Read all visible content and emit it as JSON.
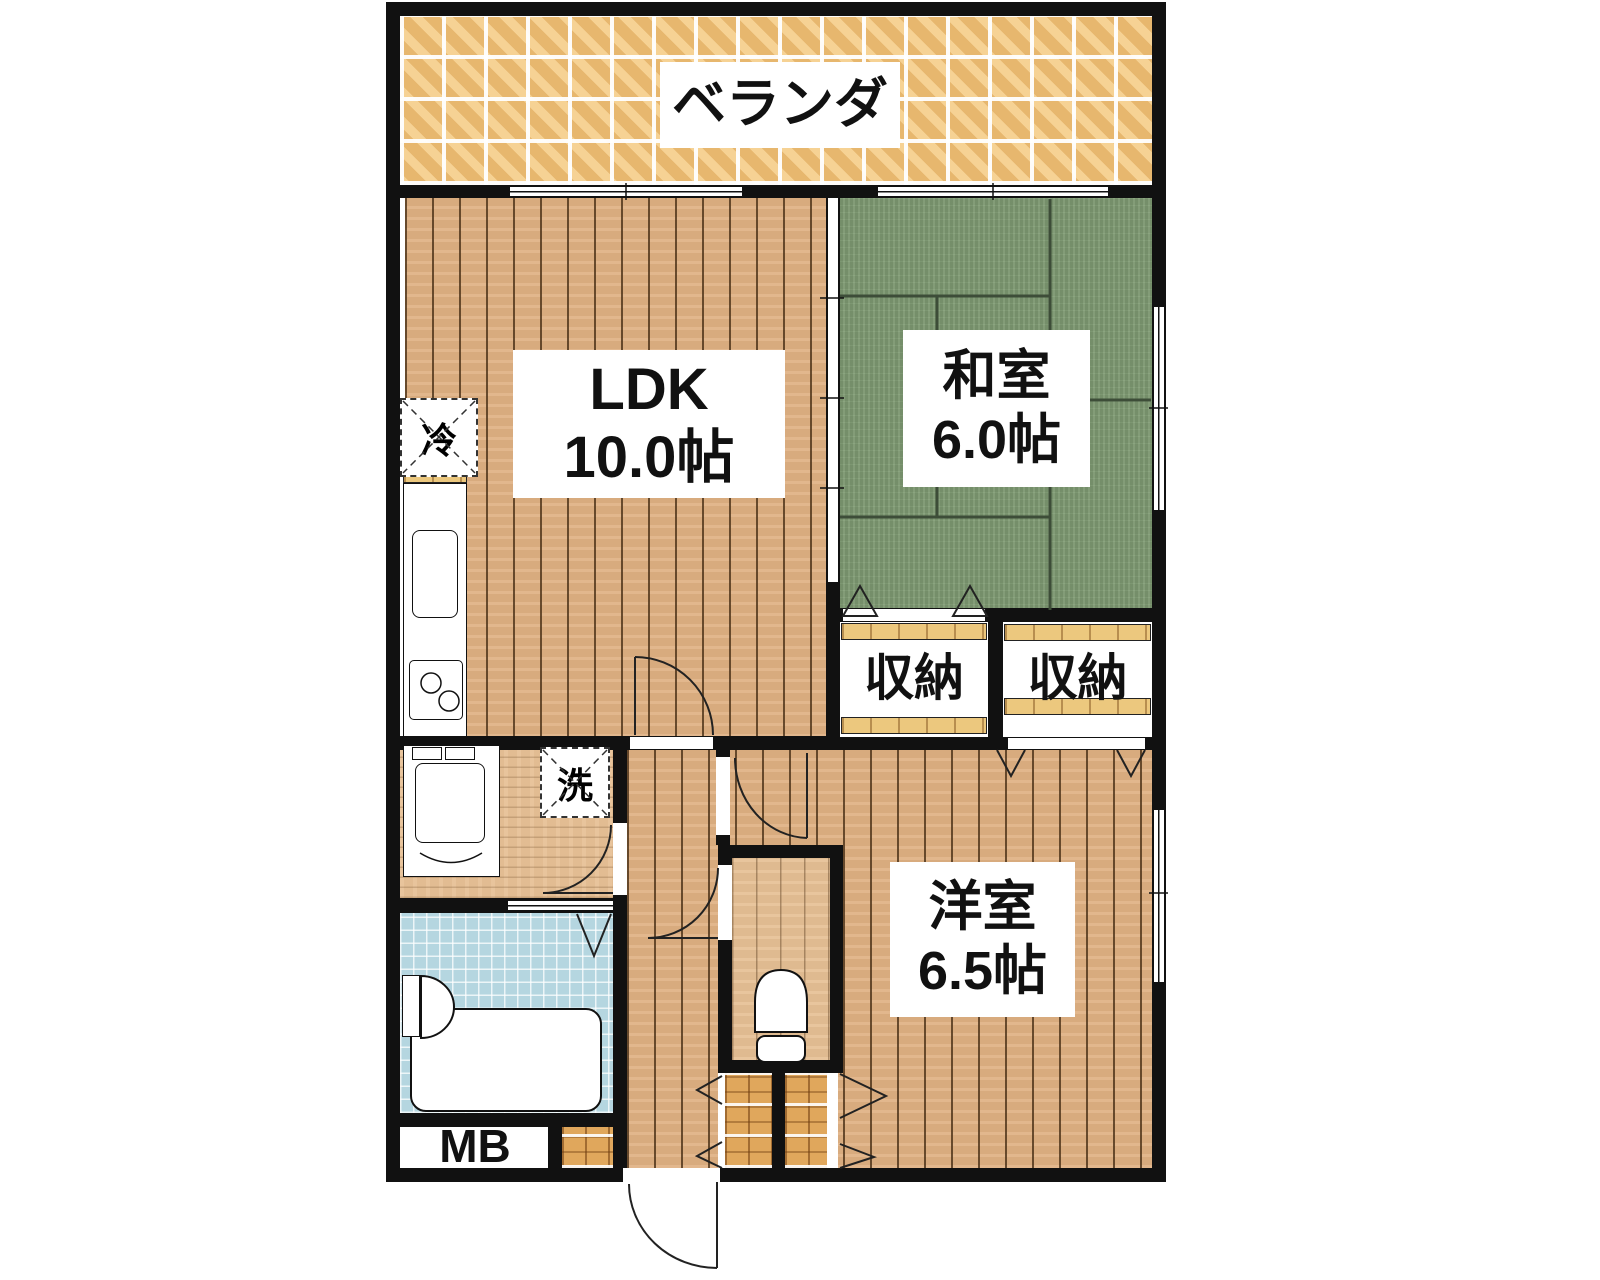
{
  "plan_title": "2DK floor plan",
  "rooms": {
    "balcony": {
      "label": "ベランダ"
    },
    "ldk": {
      "label": "LDK",
      "size": "10.0帖"
    },
    "japanese_room": {
      "label": "和室",
      "size": "6.0帖"
    },
    "western_room": {
      "label": "洋室",
      "size": "6.5帖"
    },
    "storage_left": {
      "label": "収納"
    },
    "storage_right": {
      "label": "収納"
    },
    "refrigerator": {
      "label": "冷"
    },
    "washer": {
      "label": "洗"
    },
    "meter_box": {
      "label": "MB"
    }
  },
  "colors": {
    "wall": "#111111",
    "wood": "#e0b183",
    "wood_light": "#e6c095",
    "tatami": "#7f9b73",
    "tatami_line": "#3d4d38",
    "balcony_tile": "#eebd72",
    "bath_floor": "#b5d6e0",
    "genkan_tile": "#e0a75c",
    "shelf": "#ecc87e",
    "label_bg": "#ffffff",
    "text": "#111111"
  }
}
